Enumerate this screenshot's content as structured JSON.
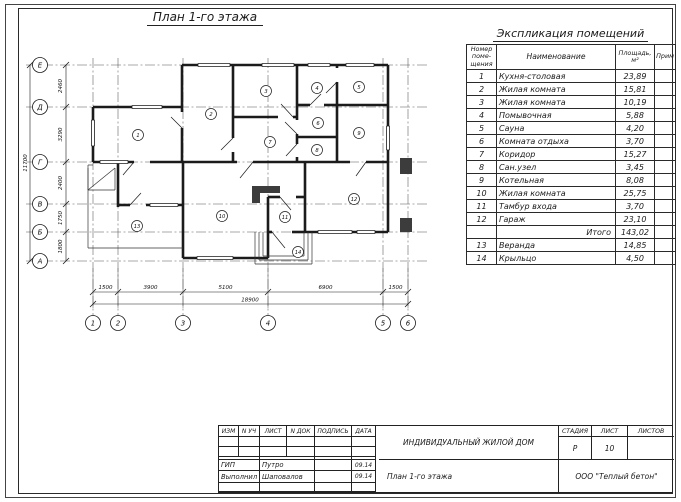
{
  "plan": {
    "title": "План 1-го этажа",
    "row_axes": [
      "Е",
      "Д",
      "Г",
      "В",
      "Б",
      "А"
    ],
    "col_axes": [
      "1",
      "2",
      "3",
      "4",
      "5",
      "6"
    ],
    "dims_v": [
      "2460",
      "3290",
      "2400",
      "1750",
      "1800"
    ],
    "dims_v_total": "11700",
    "dims_h": [
      "1500",
      "3900",
      "5100",
      "6900",
      "1500"
    ],
    "dims_h_total": "18900",
    "rooms": [
      "1",
      "2",
      "3",
      "4",
      "5",
      "6",
      "7",
      "8",
      "9",
      "10",
      "11",
      "12",
      "13",
      "14"
    ]
  },
  "explication": {
    "title": "Экспликация помещений",
    "headers": {
      "num1": "Номер",
      "num2": "поме-",
      "num3": "щения",
      "name": "Наименование",
      "area1": "Площадь,",
      "area2": "м²",
      "note": "Прим"
    },
    "rows": [
      {
        "n": "1",
        "name": "Кухня-столовая",
        "area": "23,89"
      },
      {
        "n": "2",
        "name": "Жилая комната",
        "area": "15,81"
      },
      {
        "n": "3",
        "name": "Жилая комната",
        "area": "10,19"
      },
      {
        "n": "4",
        "name": "Помывочная",
        "area": "5,88"
      },
      {
        "n": "5",
        "name": "Сауна",
        "area": "4,20"
      },
      {
        "n": "6",
        "name": "Комната отдыха",
        "area": "3,70"
      },
      {
        "n": "7",
        "name": "Коридор",
        "area": "15,27"
      },
      {
        "n": "8",
        "name": "Сан.узел",
        "area": "3,45"
      },
      {
        "n": "9",
        "name": "Котельная",
        "area": "8,08"
      },
      {
        "n": "10",
        "name": "Жилая комната",
        "area": "25,75"
      },
      {
        "n": "11",
        "name": "Тамбур входа",
        "area": "3,70"
      },
      {
        "n": "12",
        "name": "Гараж",
        "area": "23,10"
      },
      {
        "n": "",
        "name": "Итого",
        "area": "143,02",
        "total": true
      },
      {
        "n": "13",
        "name": "Веранда",
        "area": "14,85"
      },
      {
        "n": "14",
        "name": "Крыльцо",
        "area": "4,50"
      }
    ]
  },
  "titleblock": {
    "headers_left": [
      "ИЗМ",
      "N УЧ",
      "ЛИСТ",
      "N ДОК",
      "ПОДПИСЬ",
      "ДАТА"
    ],
    "sign_rows": [
      {
        "role": "ГИП",
        "name": "Путро",
        "sign": "",
        "date": "09.14"
      },
      {
        "role": "Выполнил",
        "name": "Шаповалов",
        "sign": "",
        "date": "09.14"
      }
    ],
    "project": "ИНДИВИДУАЛЬНЫЙ ЖИЛОЙ ДОМ",
    "sheet_title": "План 1-го этажа",
    "stage_label": "СТАДИЯ",
    "list_label": "ЛИСТ",
    "listov_label": "ЛИСТОВ",
    "stage_value": "Р",
    "list_value": "10",
    "listov_value": "",
    "company": "ООО \"Теплый бетон\""
  }
}
